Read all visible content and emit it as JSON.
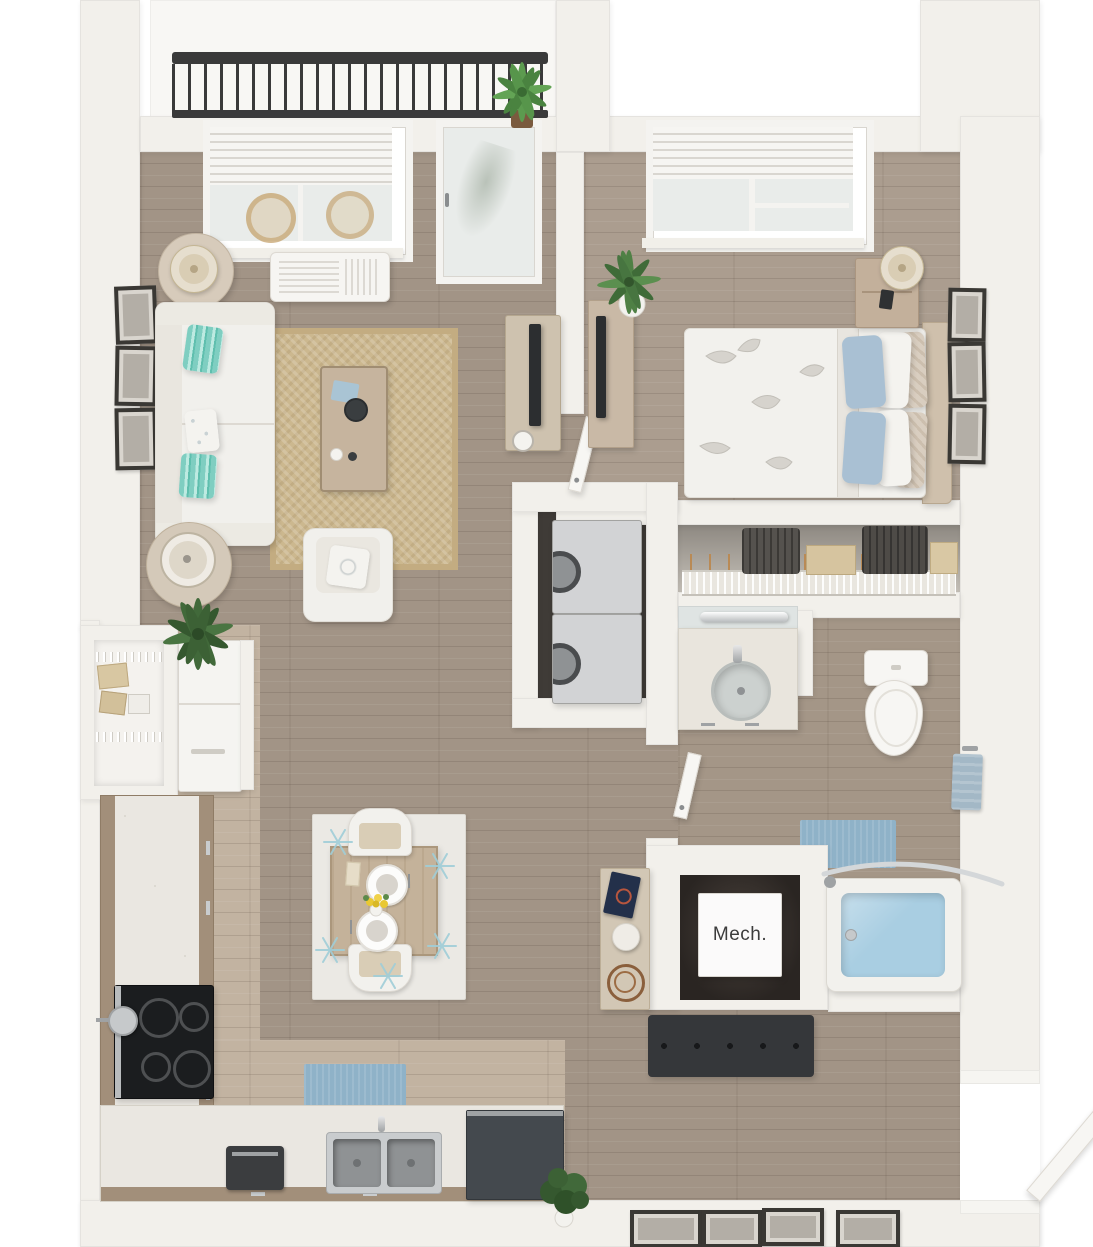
{
  "labels": {
    "mech": "Mech."
  },
  "colors": {
    "wall": "#f2f0eb",
    "wood-living": "#a29486",
    "wood-kitchen": "#c2b3a1",
    "wood-bedroom": "#ab9d8f",
    "wood-bath": "#a49687",
    "balcony-floor": "#f8f7f4",
    "railing": "#3a3a3a",
    "sofa-white": "#f1f0ec",
    "pillow-teal": "#7fcec1",
    "pillow-white": "#f4f3ef",
    "pillow-blue": "#a9c0d3",
    "pillow-tan": "#d9cec0",
    "rug-jute": "#ccb88f",
    "rug-dining": "#ebe9e4",
    "rug-accent": "#a0ced8",
    "mat-blue": "#8fb2c8",
    "wood-furniture": "#c6b49e",
    "wood-dark": "#9d8a75",
    "appliance-gray": "#d2d3d5",
    "appliance-dark": "#44494e",
    "steel": "#b9bcbe",
    "stove-black": "#1b1d1f",
    "water-blue": "#a9cee2",
    "bench-dark": "#35373a",
    "tv-black": "#2c2e30",
    "mech-interior": "#2a2522",
    "mech-text": "#3c3c3c",
    "plant-green": "#4d7c44",
    "plant-green-dark": "#3a5f33",
    "glass": "#e9ecea",
    "blind-white": "#f6f5f2",
    "frame-dark": "#3a3834",
    "lamp-beige": "#d9cdb4"
  },
  "scene": {
    "type": "3d-rendered top-down floor plan of a one-bedroom apartment",
    "rooms": [
      "balcony",
      "living-room",
      "bedroom",
      "walk-in-closet",
      "laundry-closet",
      "bathroom",
      "mechanical-closet",
      "kitchen",
      "dining-area",
      "pantry",
      "entry-hall"
    ],
    "furnishings": {
      "balcony": [
        "metal-railing",
        "potted-plant"
      ],
      "living-room": [
        "window-with-blinds",
        "wall-ac-unit",
        "balcony-glass-door",
        "sofa",
        "throw-pillows",
        "jute-rug",
        "coffee-table",
        "armchair",
        "tv-console",
        "tv",
        "side-tables",
        "lamps",
        "wall-frames",
        "floor-plant"
      ],
      "bedroom": [
        "window-with-blinds",
        "queen-bed",
        "floral-duvet",
        "pillows",
        "headboard",
        "nightstand",
        "table-lamp",
        "phone",
        "desk",
        "monitor",
        "potted-plant",
        "wall-frames",
        "door"
      ],
      "walk-in-closet": [
        "wire-shelf",
        "hangers",
        "clothes",
        "storage-boxes"
      ],
      "laundry-closet": [
        "stacked-washer",
        "stacked-dryer"
      ],
      "bathroom": [
        "vanity-sink",
        "mirror-light-bar",
        "toilet",
        "towel-ring",
        "bath-mat",
        "bathtub",
        "curved-shower-rod",
        "door"
      ],
      "mechanical-closet": [
        "mechanical-unit"
      ],
      "kitchen": [
        "pantry-wire-shelves",
        "refrigerator",
        "l-shaped-counter",
        "cooktop",
        "oven",
        "pan",
        "double-sink",
        "faucet",
        "coffee-maker",
        "dishwasher",
        "blue-mat",
        "decor-plate"
      ],
      "dining-area": [
        "patterned-rug",
        "dining-table",
        "two-chairs",
        "place-settings",
        "yellow-flowers"
      ],
      "entry-hall": [
        "entry-door",
        "bench",
        "console-table",
        "decor-book",
        "decor-sphere",
        "decor-orb",
        "floor-plant",
        "leaning-frames"
      ]
    }
  }
}
